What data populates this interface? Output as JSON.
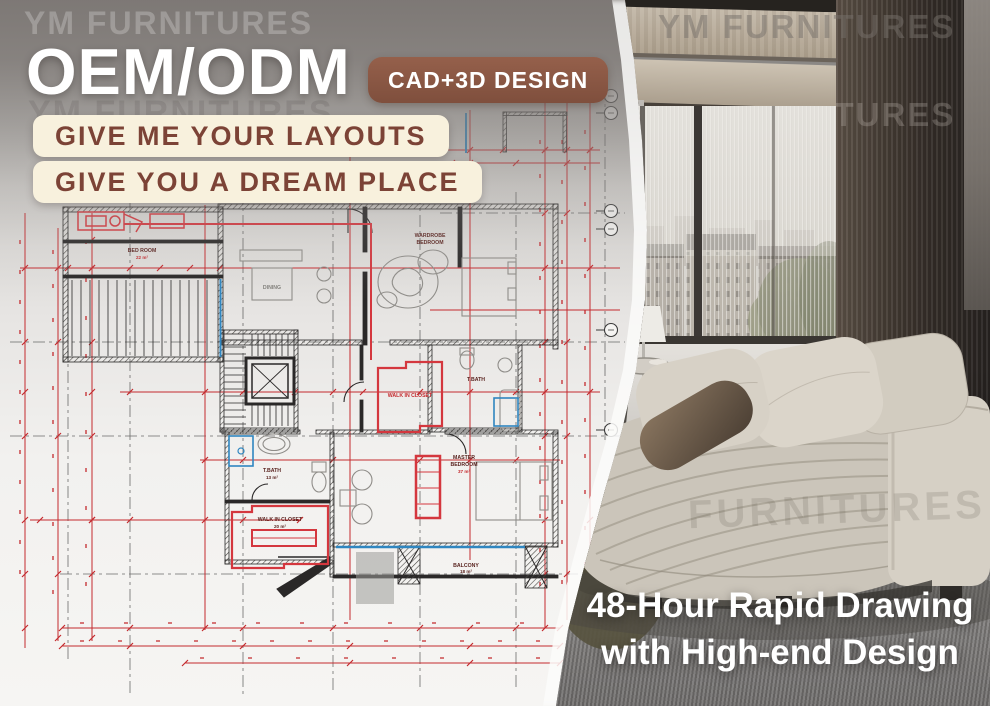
{
  "canvas": {
    "width": 990,
    "height": 706
  },
  "left_panel": {
    "watermark": "YM FURNITURES",
    "watermark_ghost": "YM FURNITURES",
    "title": "OEM/ODM",
    "badge": "CAD+3D DESIGN",
    "tagline_1": "GIVE ME YOUR LAYOUTS",
    "tagline_2": "GIVE YOU A DREAM PLACE"
  },
  "floorplan": {
    "labels": {
      "bedroom": "BED ROOM",
      "bedroom_area": "22 m²",
      "wardrobe_line1": "WARDROBE",
      "wardrobe_line2": "BEDROOM",
      "dining": "DINING",
      "closet_upper": "WALK IN CLOSET",
      "bath_upper": "T.BATH",
      "bath_lower": "T.BATH",
      "bath_lower_area": "13 m²",
      "master_line1": "MASTER",
      "master_line2": "BEDROOM",
      "master_area": "37 m²",
      "closet_lower": "WALK IN CLOSET",
      "closet_lower_area": "20 m²",
      "balcony": "BALCONY",
      "balcony_area": "18 m²"
    },
    "colors": {
      "wall": "#2a2828",
      "dimension": "#c42a2e",
      "accent_blue": "#2f86c0",
      "furniture": "#8f8d89",
      "closet_red": "#d4373e"
    }
  },
  "photo_panel": {
    "watermark_top": "YM FURNITURES",
    "watermark_partial": "YM FURNITURES",
    "watermark_sofa": "FURNITURES",
    "caption_line1": "48-Hour Rapid Drawing",
    "caption_line2": "with High-end Design"
  },
  "colors": {
    "badge_bg": "#8a5948",
    "pill_bg": "#f8f1dd",
    "pill_text": "#7c4336",
    "caption_text": "#ffffff"
  }
}
